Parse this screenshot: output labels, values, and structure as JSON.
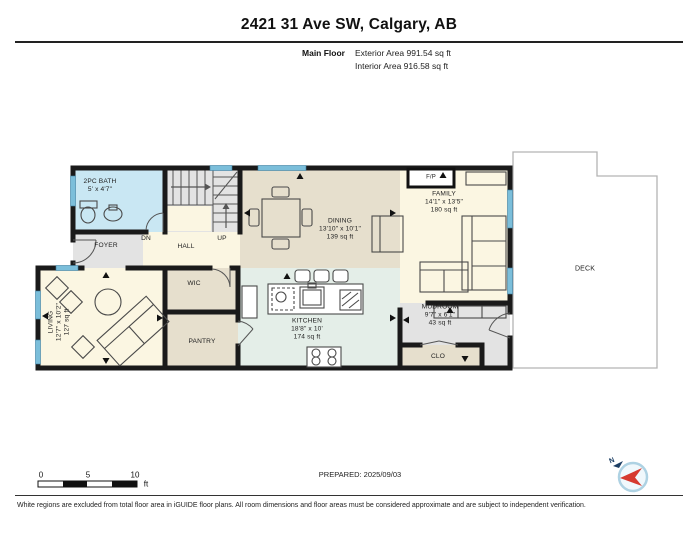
{
  "header": {
    "title": "2421 31 Ave SW, Calgary, AB",
    "floor_label": "Main Floor",
    "exterior_area": "Exterior Area 991.54 sq ft",
    "interior_area": "Interior Area 916.58 sq ft"
  },
  "rooms": {
    "bath": {
      "name": "2PC BATH",
      "dims": "5' x 4'7\""
    },
    "foyer": {
      "name": "FOYER"
    },
    "hall": {
      "name": "HALL"
    },
    "stair_down": "DN",
    "stair_up": "UP",
    "dining": {
      "name": "DINING",
      "dims": "13'10\" x 10'1\"",
      "area": "139 sq ft"
    },
    "family": {
      "name": "FAMILY",
      "dims": "14'1\" x 13'5\"",
      "area": "180 sq ft"
    },
    "fireplace": "F/P",
    "living": {
      "name": "LIVING",
      "dims": "12'7\" x 10'2\"",
      "area": "127 sq ft"
    },
    "wic": {
      "name": "WIC"
    },
    "pantry": {
      "name": "PANTRY"
    },
    "kitchen": {
      "name": "KITCHEN",
      "dims": "18'8\" x 10'",
      "area": "174 sq ft"
    },
    "mudroom": {
      "name": "MUDROOM",
      "dims": "9'7\" x 6'1\"",
      "area": "43 sq ft"
    },
    "closet": {
      "name": "CLO"
    },
    "deck": {
      "name": "DECK"
    }
  },
  "scale_bar": {
    "tick_0": "0",
    "tick_5": "5",
    "tick_10": "10",
    "unit": "ft"
  },
  "footer": {
    "prepared": "PREPARED: 2025/09/03",
    "compass_north": "N",
    "disclaimer": "White regions are excluded from total floor area in iGUIDE floor plans. All room dimensions and floor areas must be considered approximate and are subject to independent verification."
  },
  "colors": {
    "wall": "#1a1a1a",
    "window_blue": "#7bbeda",
    "room_cream": "#fbf6e2",
    "room_tan": "#e6dfcd",
    "room_mint": "#e4eee8",
    "room_gray": "#e3e3e3",
    "room_bath_blue": "#c9e7f3",
    "deck_border": "#b3b3b3",
    "compass_red": "#d63a2f"
  }
}
